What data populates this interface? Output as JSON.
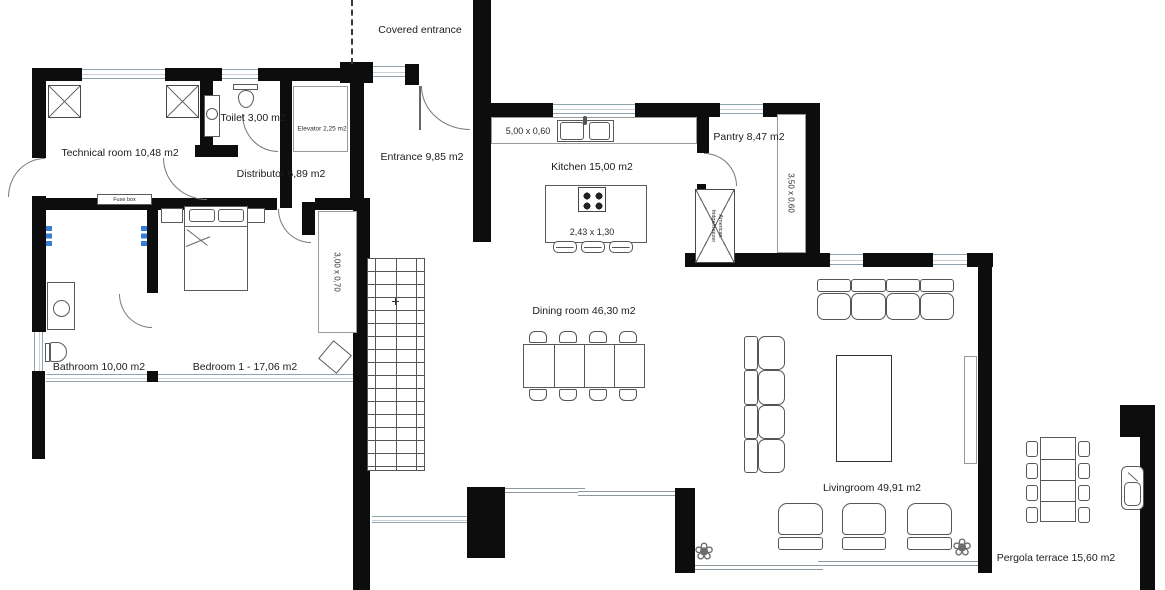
{
  "rooms": {
    "covered_entrance": "Covered entrance",
    "technical_room": "Technical room 10,48 m2",
    "toilet": "Toilet 3,00 m2",
    "elevator": "Elevator 2,25 m2",
    "entrance": "Entrance 9,85 m2",
    "distributor": "Distributor 6,89 m2",
    "kitchen": "Kitchen 15,00 m2",
    "pantry": "Pantry 8,47 m2",
    "dining_room": "Dining room 46,30 m2",
    "bedroom": "Bedroom 1 - 17,06 m2",
    "bathroom": "Bathroom 10,00 m2",
    "livingroom": "Livingroom 49,91 m2",
    "pergola_terrace": "Pergola terrace 15,60 m2"
  },
  "dimensions": {
    "kitchen_counter": "5,00 x 0,60",
    "kitchen_island": "2,43 x 1,30",
    "pantry_shelf": "3,50 x 0,60",
    "bedroom_wardrobe": "3,00 x 0,70"
  },
  "labels": {
    "fuse_box": "Fuse box",
    "fridge_line1": "American",
    "fridge_line2": "fridge/freezer"
  },
  "icons": {
    "plant": "❀"
  },
  "colors": {
    "wall": "#0d0d0d",
    "window_line": "#8fa3ae",
    "radiator_blue": "#3a7bd5"
  }
}
